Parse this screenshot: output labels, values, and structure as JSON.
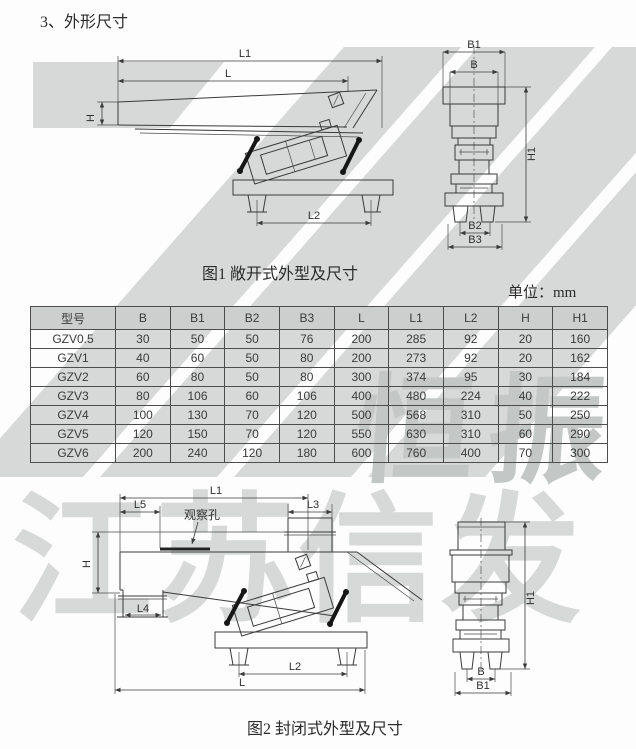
{
  "page": {
    "title": "3、外形尺寸",
    "unit_label": "单位：mm"
  },
  "watermark": {
    "brand_right": "恒振",
    "brand_bottom": "江苏信发",
    "logo_color": "#d7d9d8",
    "right_text_color": "#c3c7c6",
    "bottom_text_color": "#d7d9d8"
  },
  "figure1": {
    "caption": "图1 敞开式外型及尺寸",
    "dims": {
      "L1": "L1",
      "L": "L",
      "H": "H",
      "L2": "L2",
      "B1": "B1",
      "B": "B",
      "H1": "H1",
      "B2": "B2",
      "B3": "B3"
    }
  },
  "figure2": {
    "caption": "图2  封闭式外型及尺寸",
    "observation_hole_label": "观察孔",
    "dims": {
      "L1": "L1",
      "L5": "L5",
      "L3": "L3",
      "H": "H",
      "L4": "L4",
      "L2": "L2",
      "L": "L",
      "H1": "H1",
      "B": "B",
      "B1": "B1"
    }
  },
  "table": {
    "columns": [
      "型号",
      "B",
      "B1",
      "B2",
      "B3",
      "L",
      "L1",
      "L2",
      "H",
      "H1"
    ],
    "rows": [
      [
        "GZV0.5",
        "30",
        "50",
        "50",
        "76",
        "200",
        "285",
        "92",
        "20",
        "160"
      ],
      [
        "GZV1",
        "40",
        "60",
        "50",
        "80",
        "200",
        "273",
        "92",
        "20",
        "162"
      ],
      [
        "GZV2",
        "60",
        "80",
        "50",
        "80",
        "300",
        "374",
        "95",
        "30",
        "184"
      ],
      [
        "GZV3",
        "80",
        "106",
        "60",
        "106",
        "400",
        "480",
        "224",
        "40",
        "222"
      ],
      [
        "GZV4",
        "100",
        "130",
        "70",
        "120",
        "500",
        "568",
        "310",
        "50",
        "250"
      ],
      [
        "GZV5",
        "120",
        "150",
        "70",
        "120",
        "550",
        "630",
        "310",
        "60",
        "290"
      ],
      [
        "GZV6",
        "200",
        "240",
        "120",
        "180",
        "600",
        "760",
        "400",
        "70",
        "300"
      ]
    ]
  }
}
